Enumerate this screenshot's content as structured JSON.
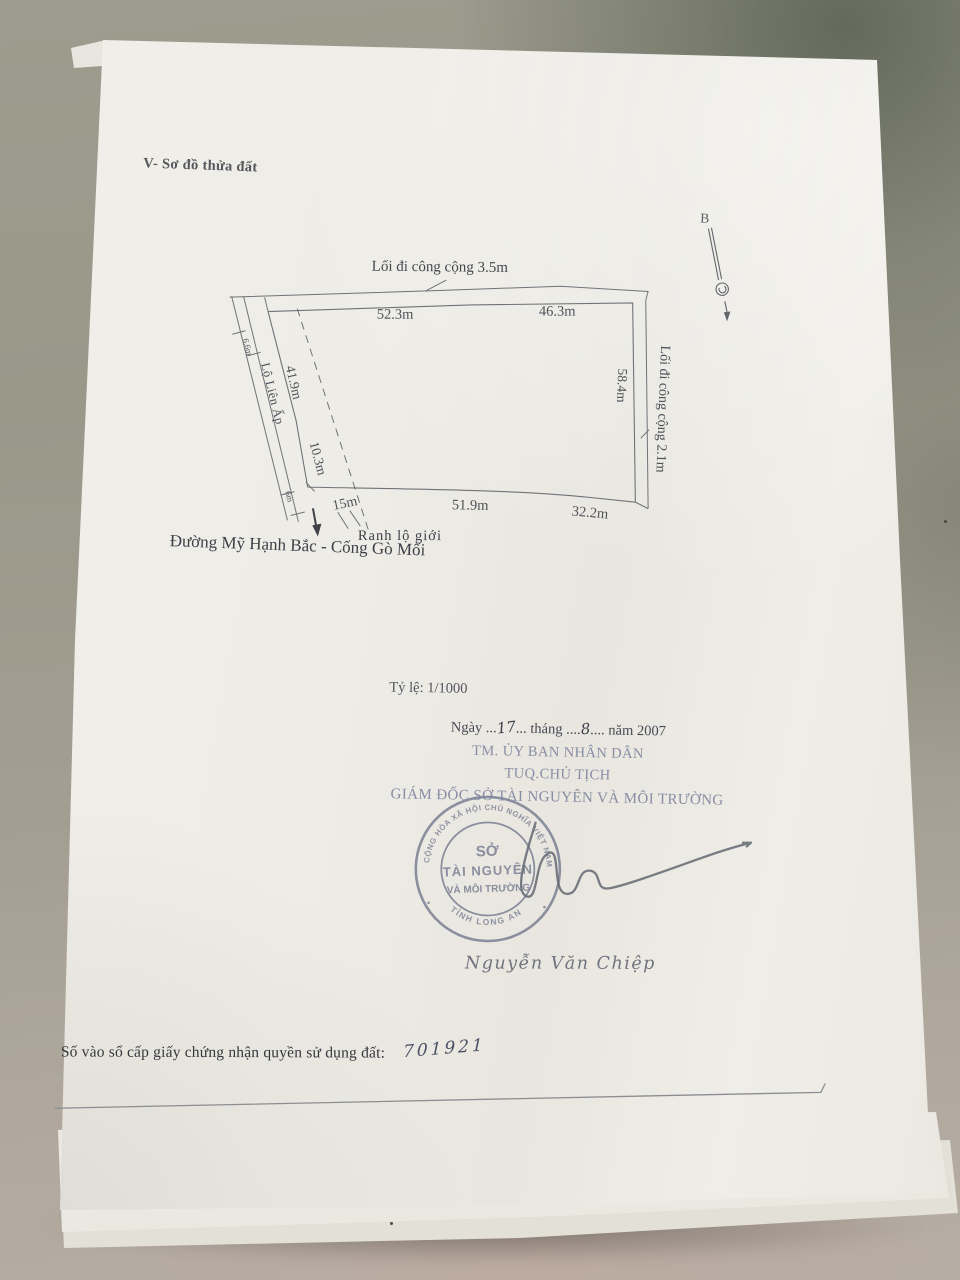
{
  "document": {
    "section_heading": "V- Sơ đồ thửa đất",
    "diagram": {
      "compass_label": "B",
      "top_road_label": "Lối đi công cộng 3.5m",
      "right_road_label": "Lối đi công cộng 2.1m",
      "left_road_label": "Lộ Liên Ấp",
      "bottom_boundary_label": "Ranh lộ giới",
      "bottom_road_label": "Đường Mỹ Hạnh Bắc - Cống Gò Mối",
      "measurements": {
        "top_left": "52.3m",
        "top_right": "46.3m",
        "right": "58.4m",
        "left_upper": "41.9m",
        "left_lower": "10.3m",
        "left_top_small": "6.6m",
        "bottom_small": "6m",
        "bottom_left": "15m",
        "bottom_mid": "51.9m",
        "bottom_right": "32.2m"
      }
    },
    "scale_label": "Tỷ lệ: 1/1000",
    "signing": {
      "date_prefix": "Ngày ...",
      "date_day": "17",
      "date_mid": "... tháng ....",
      "date_month": "8",
      "date_suffix": ".... năm 2007",
      "line1": "TM. ỦY BAN NHÂN DÂN",
      "line2": "TUQ.CHỦ TỊCH",
      "line3": "GIÁM ĐỐC SỞ TÀI NGUYÊN VÀ MÔI TRƯỜNG",
      "signer_name": "Nguyễn Văn Chiệp"
    },
    "stamp": {
      "ring_top": "CỘNG HÒA XÃ HỘI CHỦ NGHĨA VIỆT NAM",
      "ring_bottom": "TỈNH LONG AN",
      "center_line1": "SỞ",
      "center_line2": "TÀI NGUYÊN",
      "center_line3": "VÀ MÔI TRƯỜNG"
    },
    "registry": {
      "label": "Số vào sổ cấp giấy chứng nhận quyền sử dụng đất:",
      "number": "701921"
    }
  },
  "colors": {
    "paper": "#efece7",
    "surface": "#9d9c8e",
    "ink": "#4e5258",
    "faded_ink": "#7f86a0",
    "stamp": "#767c90",
    "handwriting": "#4a5166"
  }
}
